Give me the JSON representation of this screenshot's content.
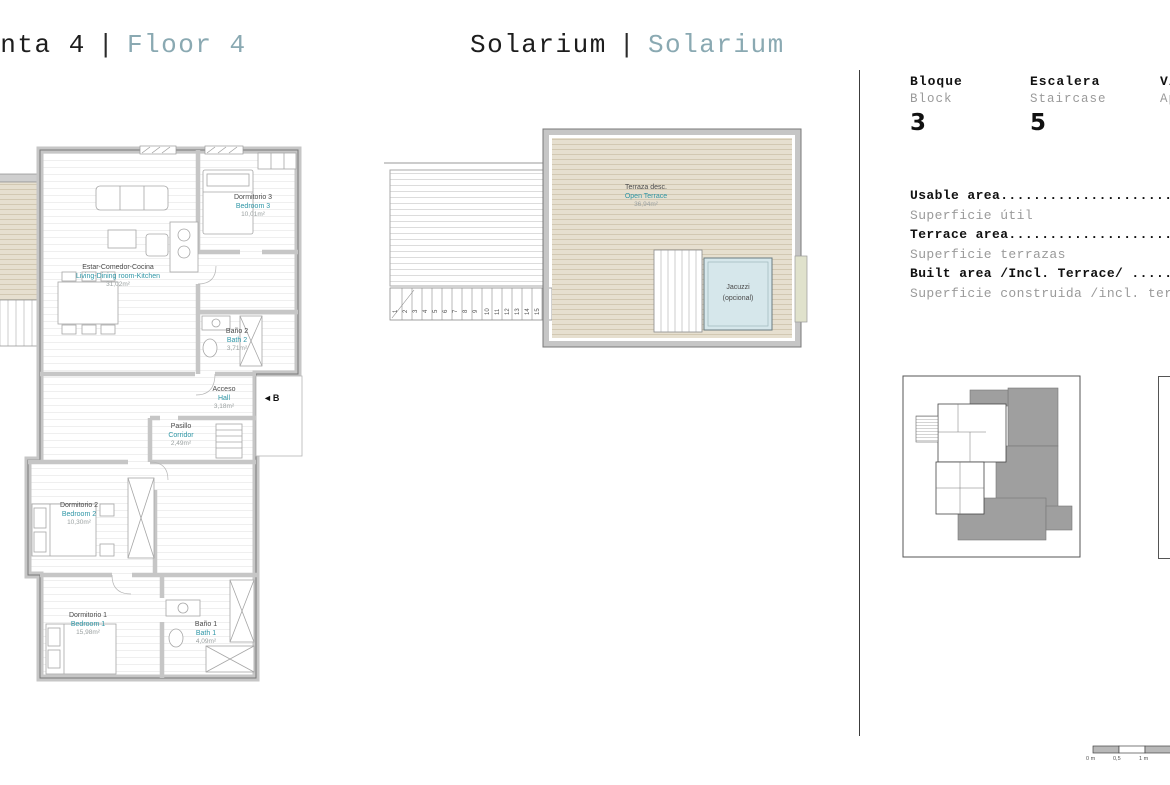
{
  "titles": {
    "floor": {
      "es": "Planta 4",
      "sep": "|",
      "en": "Floor 4"
    },
    "solarium": {
      "es": "Solarium",
      "sep": "|",
      "en": "Solarium"
    }
  },
  "info": {
    "block": {
      "es": "Bloque",
      "en": "Block",
      "value": "3"
    },
    "staircase": {
      "es": "Escalera",
      "en": "Staircase",
      "value": "5"
    },
    "unit": {
      "es": "Vivienda",
      "en": "Apartment",
      "value": ""
    },
    "areas": [
      {
        "en": "Usable area.............................",
        "es": "Superficie útil"
      },
      {
        "en": "Terrace area............................",
        "es": "Superficie terrazas"
      },
      {
        "en": "Built area /Incl. Terrace/ .............",
        "es": "Superficie construida /incl. terrazas/"
      }
    ]
  },
  "rooms": {
    "bedroom3": {
      "es": "Dormitorio 3",
      "en": "Bedroom 3",
      "area": "10,01m²"
    },
    "living": {
      "es": "Estar-Comedor-Cocina",
      "en": "Living-Dining room-Kitchen",
      "area": "31,02m²"
    },
    "bath2": {
      "es": "Baño 2",
      "en": "Bath 2",
      "area": "3,71m²"
    },
    "hall": {
      "es": "Acceso",
      "en": "Hall",
      "area": "3,18m²"
    },
    "corridor": {
      "es": "Pasillo",
      "en": "Corridor",
      "area": "2,49m²"
    },
    "bedroom2": {
      "es": "Dormitorio 2",
      "en": "Bedroom 2",
      "area": "10,30m²"
    },
    "bedroom1": {
      "es": "Dormitorio 1",
      "en": "Bedroom 1",
      "area": "15,98m²"
    },
    "bath1": {
      "es": "Baño 1",
      "en": "Bath 1",
      "area": "4,09m²"
    }
  },
  "solarium": {
    "terrace": {
      "es": "Terraza desc.",
      "en": "Open Terrace",
      "area": "36,94m²"
    },
    "jacuzzi": {
      "line1": "Jacuzzi",
      "line2": "(opcional)"
    },
    "stairs": [
      "1",
      "2",
      "3",
      "4",
      "5",
      "6",
      "7",
      "8",
      "9",
      "10",
      "11",
      "12",
      "13",
      "14",
      "15",
      "16"
    ]
  },
  "entrance_label": "◄B",
  "scalebar": {
    "zero": "0 m",
    "half": "0,5",
    "one": "1 m"
  },
  "colors": {
    "accent_teal": "#2e96a6",
    "title_teal": "#8aa9b2",
    "deck_tan": "#e6dfcf",
    "jacuzzi_blue": "#d6e7eb"
  }
}
